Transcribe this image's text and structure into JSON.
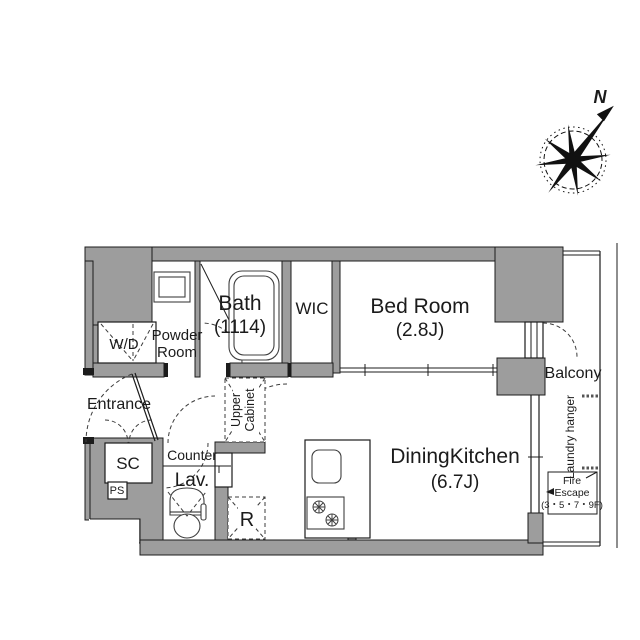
{
  "plan": {
    "rooms": {
      "bath": {
        "label": "Bath",
        "size": "(1114)"
      },
      "wic": {
        "label": "WIC"
      },
      "bedroom": {
        "label": "Bed Room",
        "size": "(2.8J)"
      },
      "powder_room": {
        "line1": "Powder",
        "line2": "Room"
      },
      "washer_dryer": {
        "label": "W/D"
      },
      "entrance": {
        "label": "Entrance"
      },
      "shoe_closet": {
        "label": "SC"
      },
      "pipe_space": {
        "label": "PS"
      },
      "counter": {
        "label": "Counter"
      },
      "lavatory": {
        "label": "Lav."
      },
      "upper_cabinet": {
        "line1": "Upper",
        "line2": "Cabinet"
      },
      "refrigerator": {
        "label": "R"
      },
      "dining_kitchen": {
        "label": "DiningKitchen",
        "size": "(6.7J)"
      },
      "balcony": {
        "label": "Balcony"
      },
      "laundry_hanger": {
        "label": "Laundry hanger"
      },
      "fire_escape": {
        "line1": "Fire",
        "line2": "Escape",
        "line3": "(3・5・7・9F)"
      }
    },
    "compass": {
      "north_label": "N"
    },
    "colors": {
      "wall": "#9d9d9d",
      "line": "#1c1c1c",
      "background": "#ffffff"
    }
  }
}
